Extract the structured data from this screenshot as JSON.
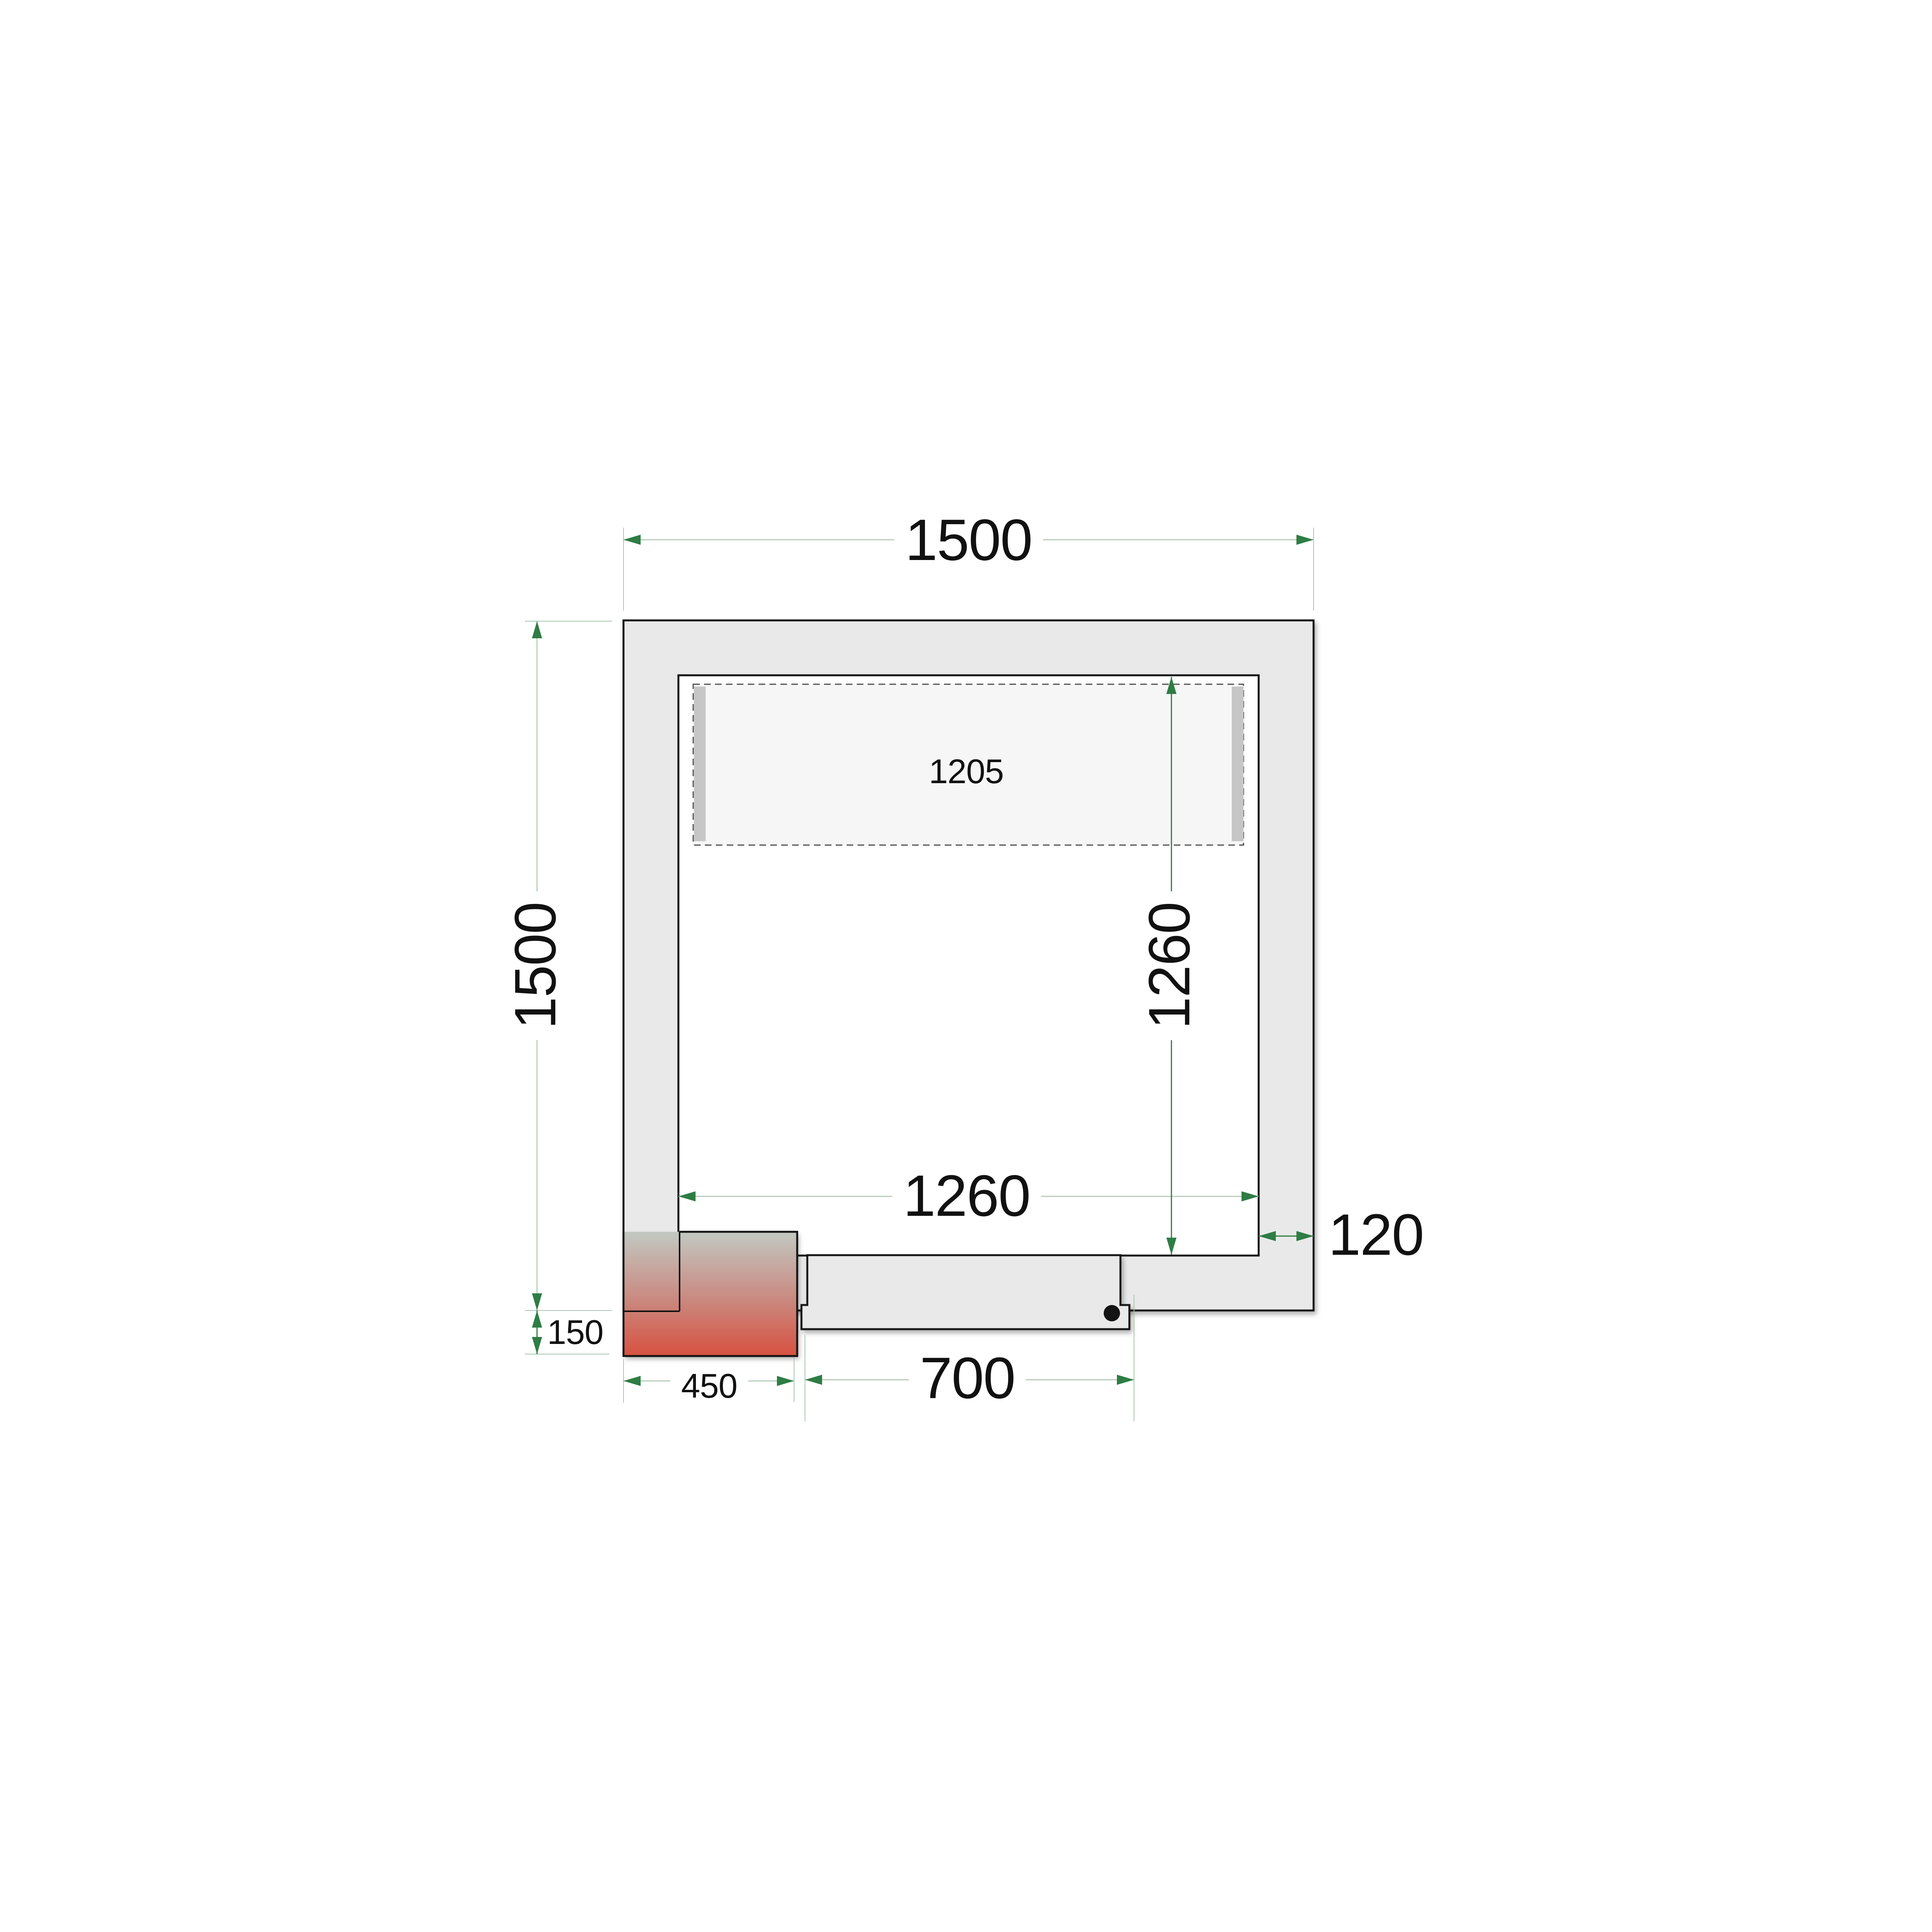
{
  "labels": {
    "overall_width": "1500",
    "overall_depth": "1500",
    "inner_width": "1260",
    "inner_depth": "1260",
    "wall_thickness": "120",
    "evaporator_width": "1205",
    "unit_overhang": "150",
    "unit_width": "450",
    "door_width": "700"
  },
  "colors": {
    "line": "#141414",
    "wall_fill": "#e9e9e9",
    "room_fill": "#ffffff",
    "evap_fill": "#f6f6f6",
    "evap_bar": "#c6c6c6",
    "evap_dash": "#4f4f4f",
    "unit_top": "#c2c8c2",
    "unit_mid": "#c98c82",
    "unit_bottom": "#d85140",
    "green_dark": "#2e7d44",
    "green_pale": "#a9c6af"
  }
}
